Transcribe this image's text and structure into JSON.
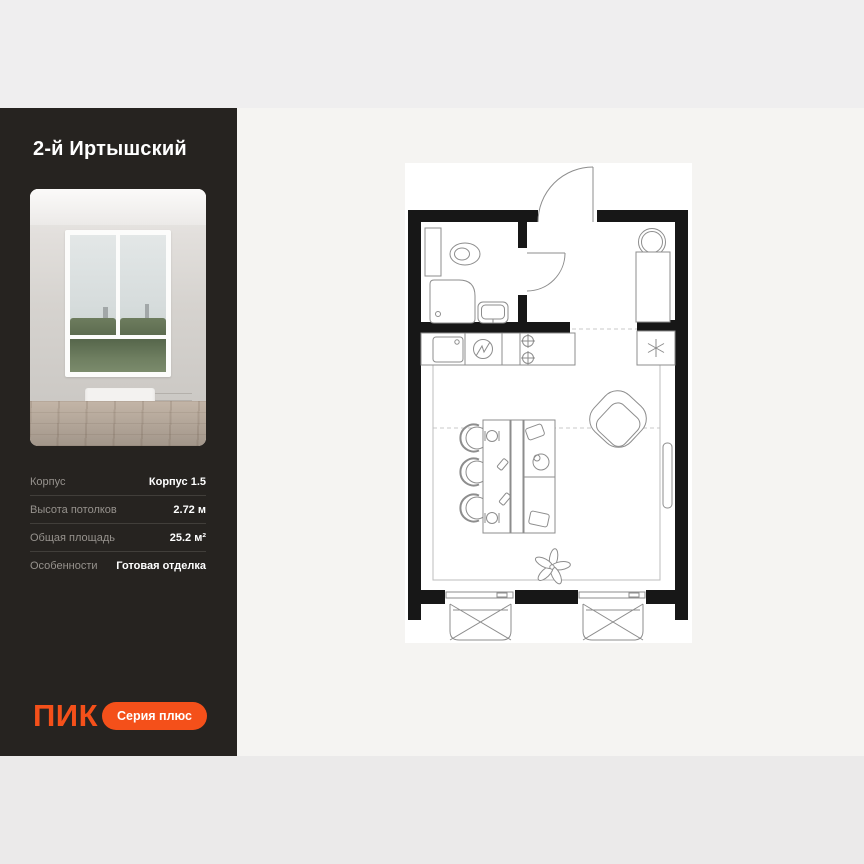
{
  "page": {
    "bg_top": "#efeeef",
    "bg_main": "#f5f4f2",
    "bg_bottom": "#ebeaea"
  },
  "sidebar": {
    "bg": "#262320",
    "accent": "#f4501a",
    "title": "2-й Иртышский",
    "specs": [
      {
        "label": "Корпус",
        "value": "Корпус 1.5"
      },
      {
        "label": "Высота потолков",
        "value": "2.72 м"
      },
      {
        "label": "Общая площадь",
        "value": "25.2 м²"
      },
      {
        "label": "Особенности",
        "value": "Готовая отделка"
      }
    ],
    "logo_text": "ПИК",
    "badge_label": "Серия плюс"
  },
  "floorplan": {
    "wall_color": "#171717",
    "line_color": "#8d8d8d",
    "elements": [
      "entrance-door",
      "bathroom-vent-shaft",
      "toilet",
      "shower",
      "bathroom-sink",
      "washing-machine",
      "wardrobe",
      "kitchen-counter",
      "kitchen-sink",
      "electric-panel",
      "stove-burners",
      "fridge",
      "dining-table",
      "chairs",
      "bed",
      "pillows",
      "armchair",
      "plant",
      "side-window",
      "french-balcony-left",
      "french-balcony-right"
    ]
  }
}
